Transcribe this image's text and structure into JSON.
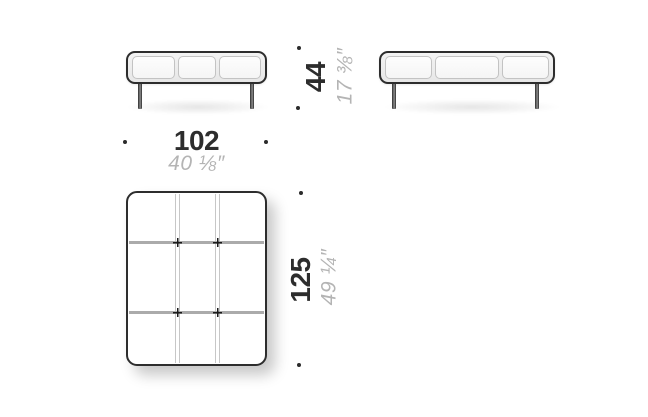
{
  "diagram": {
    "dimensions": {
      "width": {
        "cm": "102",
        "inches": "40 ⅛″"
      },
      "height": {
        "cm": "44",
        "inches": "17 ⅜″"
      },
      "depth": {
        "cm": "125",
        "inches": "49 ¼″"
      }
    },
    "colors": {
      "background": "#ffffff",
      "outline": "#2d2d2d",
      "cushion_seam_light": "#c7c7c7",
      "cushion_seam_dark": "#ababab",
      "text_primary": "#2d2d2d",
      "text_secondary": "#b4b4b4"
    }
  }
}
